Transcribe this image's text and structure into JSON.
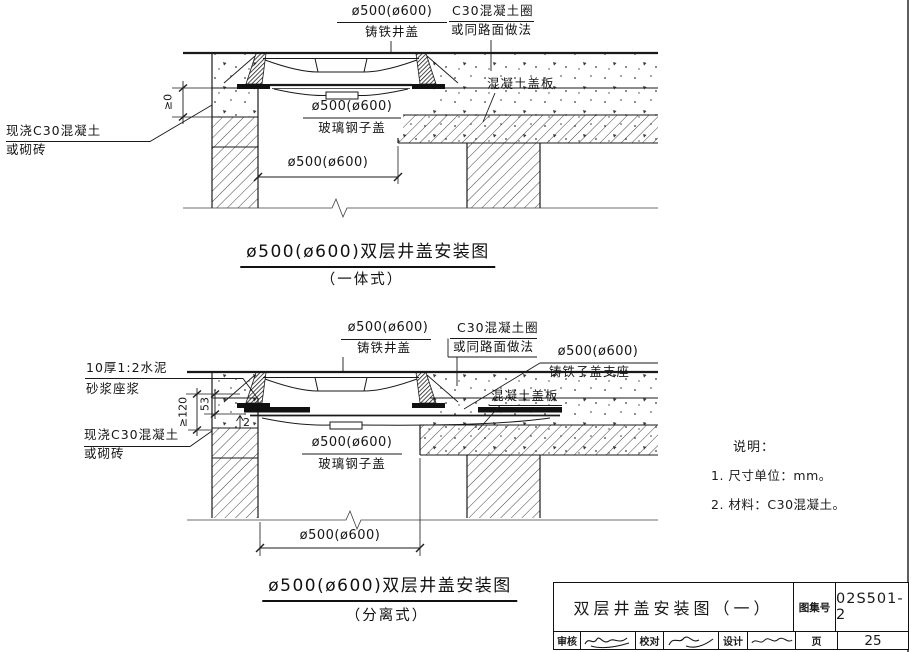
{
  "colors": {
    "ink": "#1a1a1a",
    "bg": "#ffffff"
  },
  "drawing1": {
    "cover_dia": "ø500(ø600)",
    "cover_name": "铸铁井盖",
    "ring_line1": "C30混凝土圈",
    "ring_line2": "或同路面做法",
    "slab_label": "混凝土盖板",
    "cast_line1": "现浇C30混凝土",
    "cast_line2": "或砌砖",
    "subcover_dia": "ø500(ø600)",
    "subcover_name": "玻璃钢子盖",
    "dim_collar_height": "≥0",
    "dim_opening": "ø500(ø600)",
    "title": "ø500(ø600)双层井盖安装图",
    "subtitle": "（一体式）"
  },
  "drawing2": {
    "mortar_line1": "10厚1:2水泥",
    "mortar_line2": "砂浆座浆",
    "cover_dia": "ø500(ø600)",
    "cover_name": "铸铁井盖",
    "ring_line1": "C30混凝土圈",
    "ring_line2": "或同路面做法",
    "seat_dia": "ø500(ø600)",
    "seat_name": "铸铁子盖支座",
    "slab_label": "混凝土盖板",
    "cast_line1": "现浇C30混凝土",
    "cast_line2": "或砌砖",
    "subcover_dia": "ø500(ø600)",
    "subcover_name": "玻璃钢子盖",
    "dim_depth": "≥120",
    "dim_seat": "53",
    "dim_gap": "2",
    "dim_opening": "ø500(ø600)",
    "title": "ø500(ø600)双层井盖安装图",
    "subtitle": "（分离式）"
  },
  "notes": {
    "heading": "说明：",
    "items": [
      "1. 尺寸单位：mm。",
      "2. 材料：C30混凝土。"
    ]
  },
  "title_block": {
    "drawing_title": "双层井盖安装图（一）",
    "atlas_label": "图集号",
    "atlas_number": "02S501-2",
    "reviewer_label": "审核",
    "checker_label": "校对",
    "designer_label": "设计",
    "page_label": "页",
    "page_number": "25"
  }
}
